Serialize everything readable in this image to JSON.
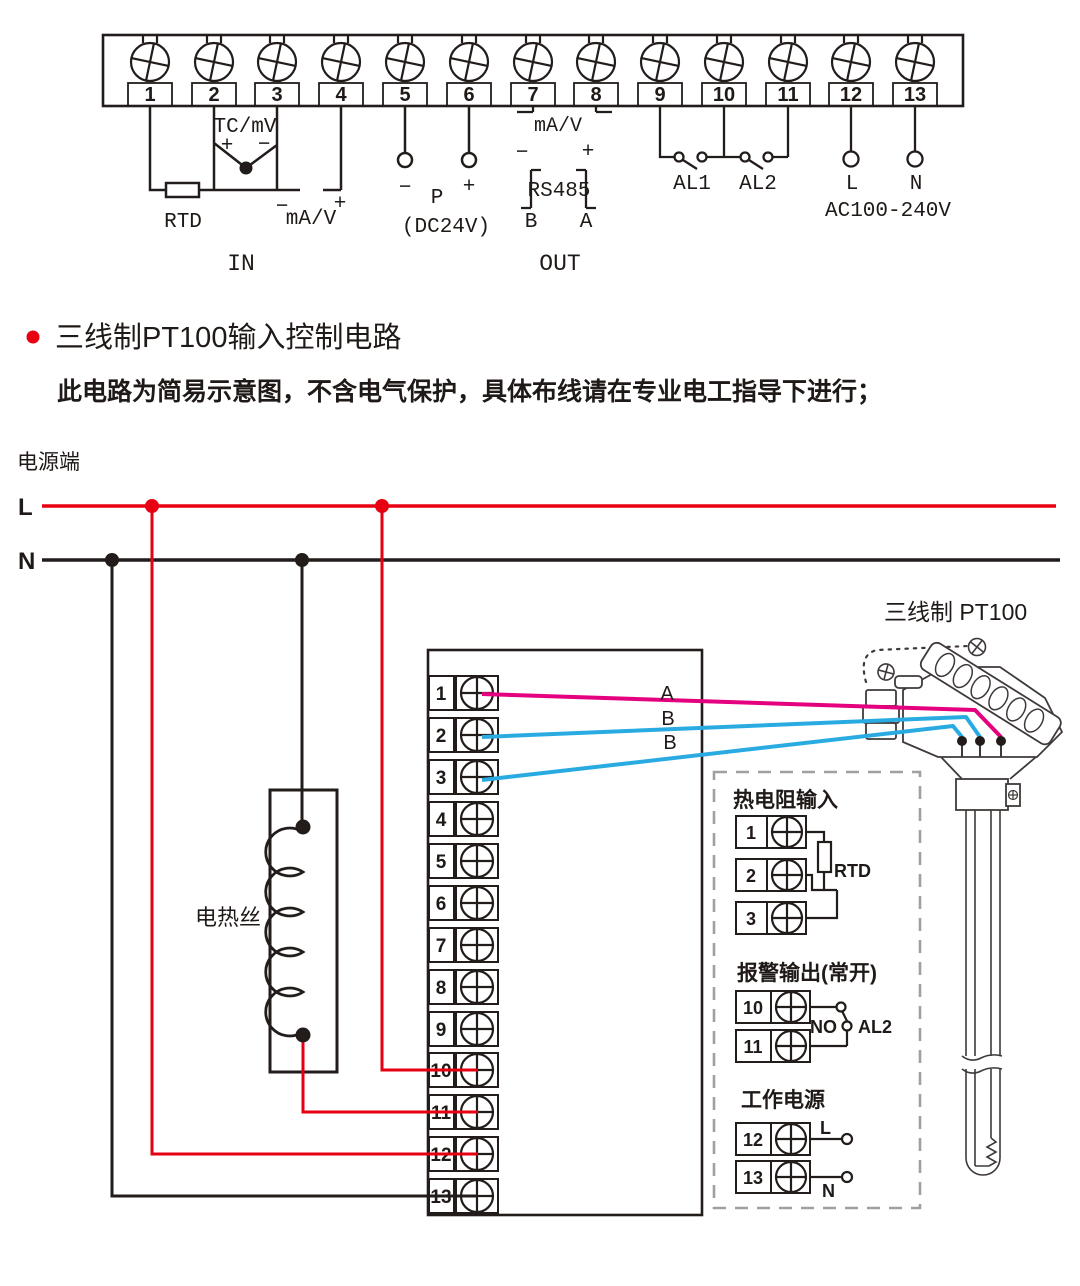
{
  "colors": {
    "line_black": "#221c1a",
    "accent_red": "#e60012",
    "wire_magenta": "#e4007f",
    "wire_blue": "#29abe2",
    "dash_gray": "#9fa0a0"
  },
  "top_block": {
    "terminals": [
      "1",
      "2",
      "3",
      "4",
      "5",
      "6",
      "7",
      "8",
      "9",
      "10",
      "11",
      "12",
      "13"
    ],
    "rtd": "RTD",
    "tc": "TC/mV",
    "plus": "+",
    "minus": "−",
    "ma_v": "mA/V",
    "in": "IN",
    "p": "P",
    "dc24v": "(DC24V)",
    "rs485": "RS485",
    "b": "B",
    "a": "A",
    "out": "OUT",
    "al1": "AL1",
    "al2": "AL2",
    "l": "L",
    "n": "N",
    "ac": "AC100-240V"
  },
  "section": {
    "title": "三线制PT100输入控制电路",
    "note": "此电路为简易示意图，不含电气保护，具体布线请在专业电工指导下进行；"
  },
  "circuit": {
    "power_label": "电源端",
    "l": "L",
    "n": "N",
    "heater": "电热丝",
    "terminals": [
      "1",
      "2",
      "3",
      "4",
      "5",
      "6",
      "7",
      "8",
      "9",
      "10",
      "11",
      "12",
      "13"
    ],
    "wire_a": "A",
    "wire_b": "B",
    "sensor_title": "三线制 PT100",
    "inset": {
      "rtd_title": "热电阻输入",
      "t1": "1",
      "t2": "2",
      "t3": "3",
      "rtd": "RTD",
      "alarm_title": "报警输出(常开)",
      "t10": "10",
      "t11": "11",
      "no": "NO",
      "al2": "AL2",
      "power_title": "工作电源",
      "t12": "12",
      "t13": "13",
      "l": "L",
      "n": "N"
    }
  }
}
